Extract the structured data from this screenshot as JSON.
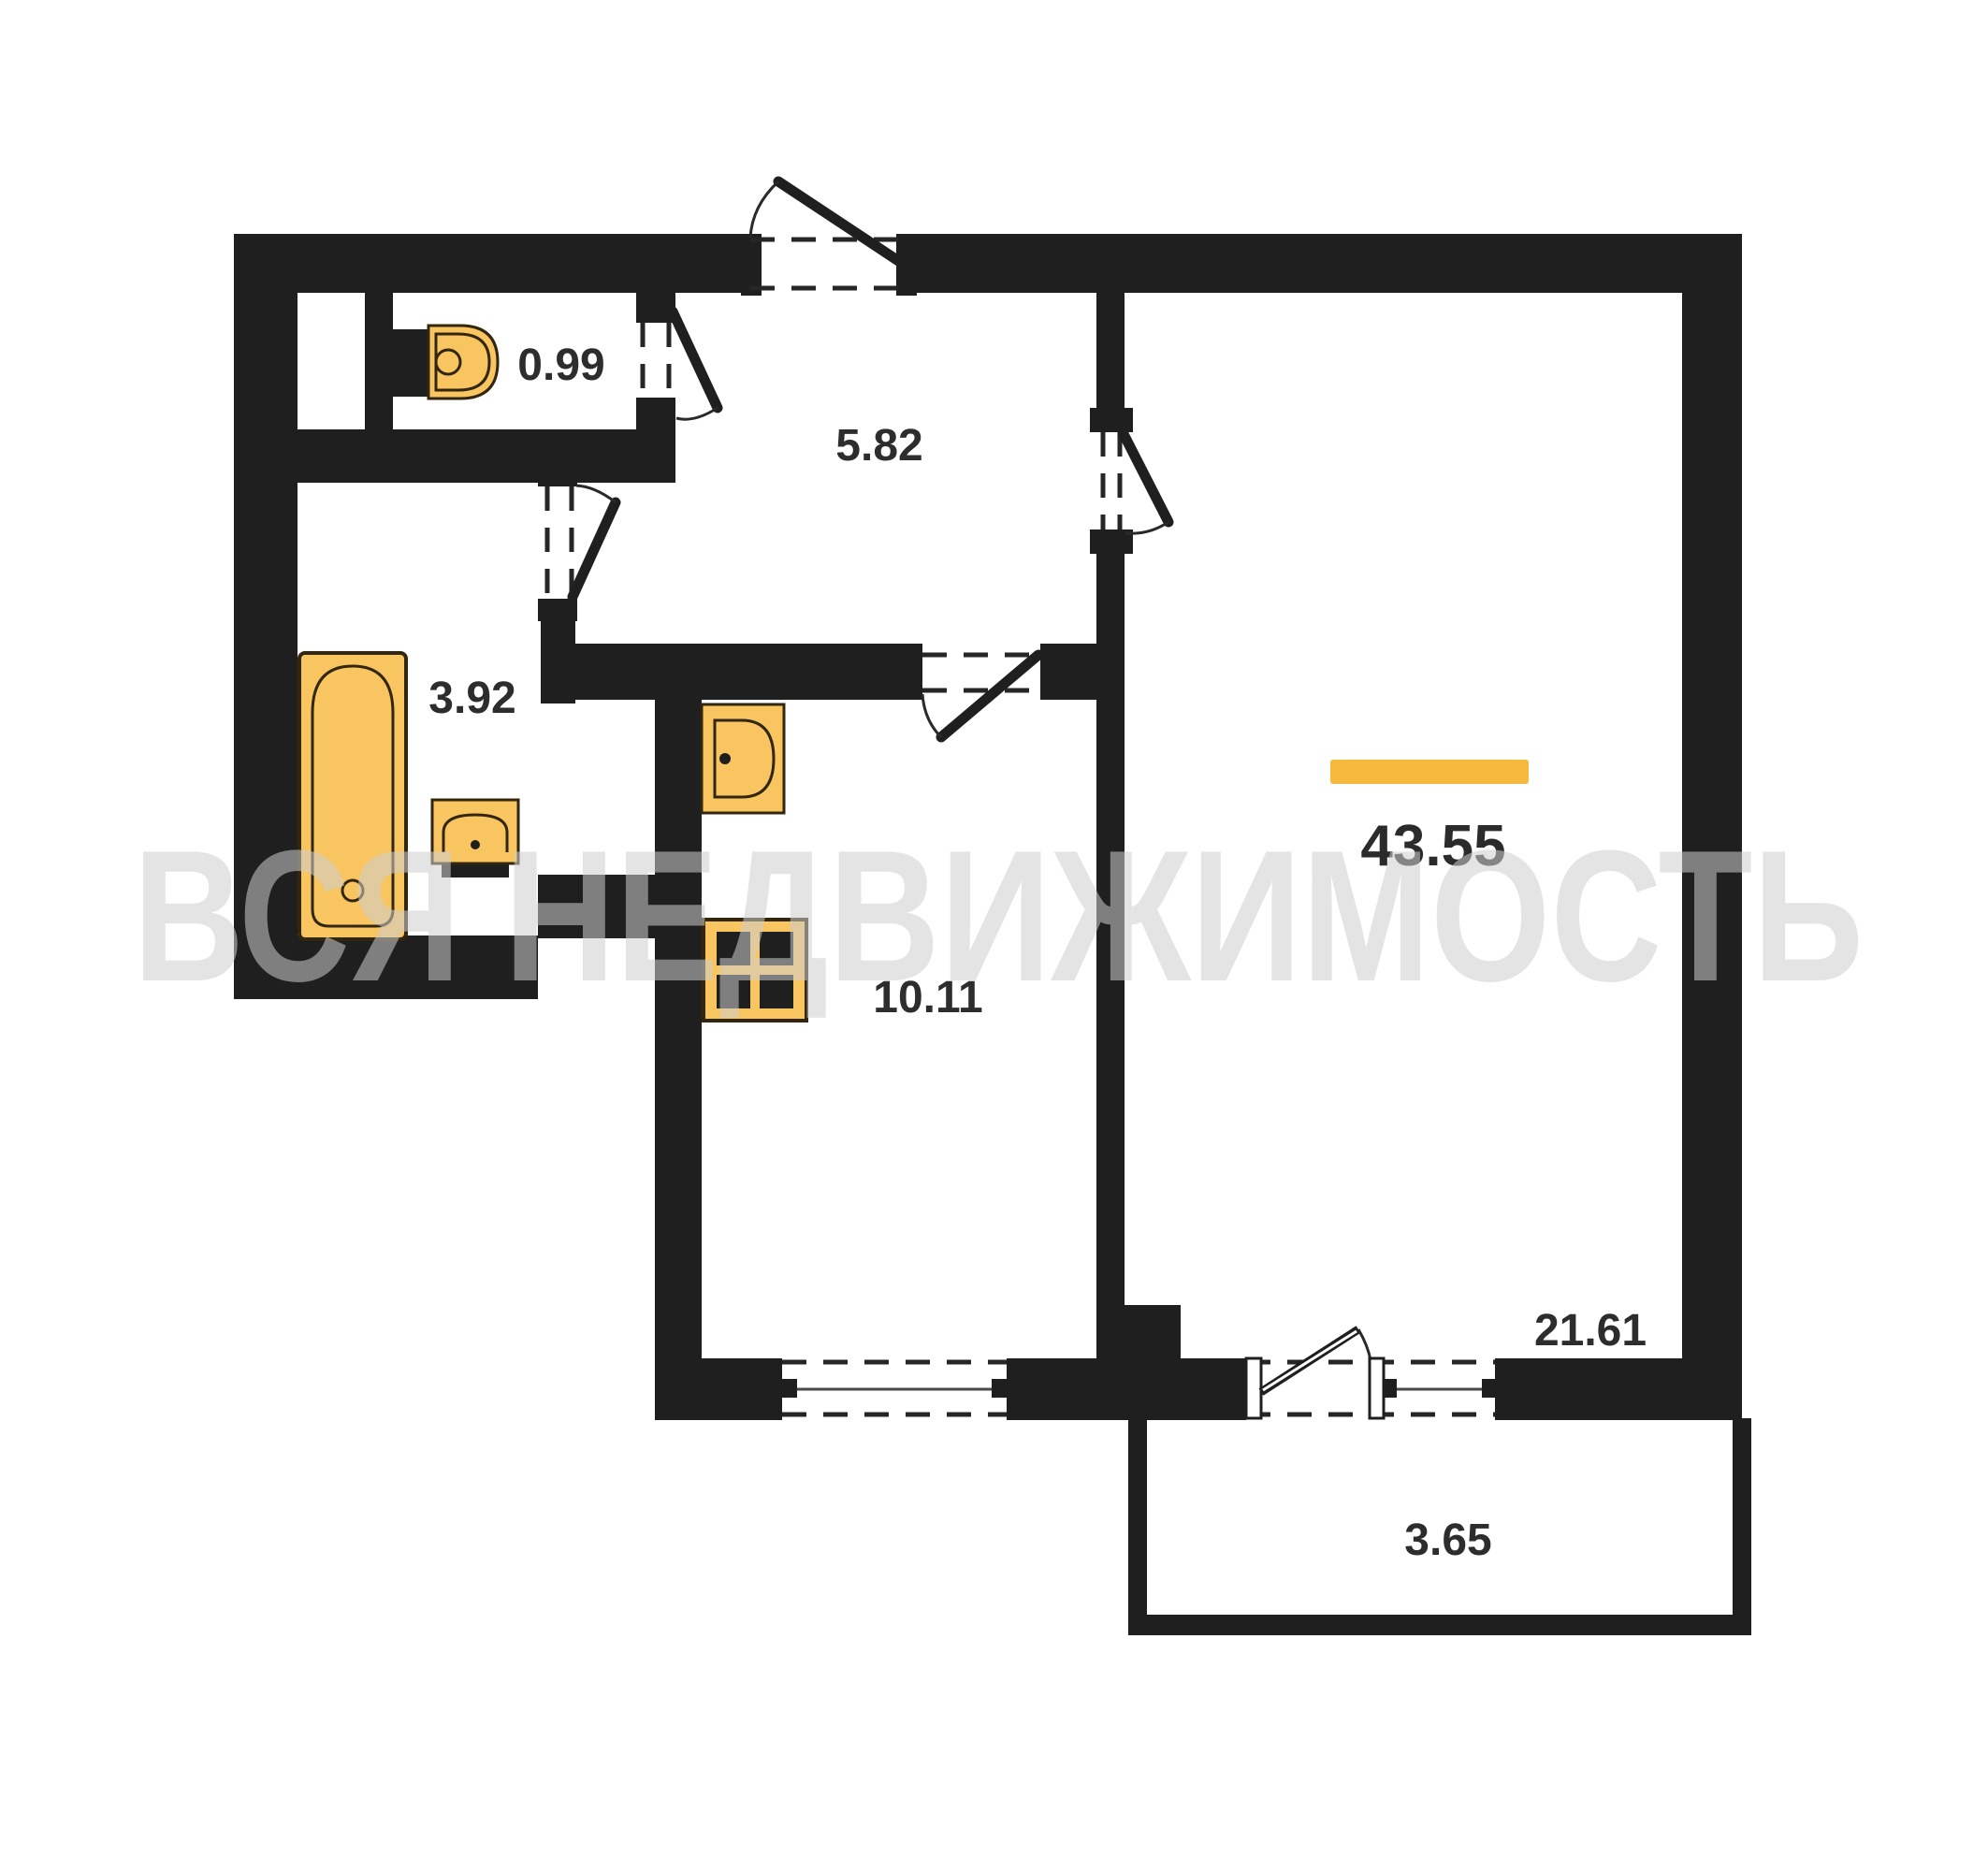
{
  "plan": {
    "title": "apartment-floor-plan",
    "watermark": "ВСЯ НЕДВИЖИМОСТЬ",
    "total_area": {
      "value": "43.55"
    },
    "rooms": [
      {
        "id": "toilet",
        "area": "0.99"
      },
      {
        "id": "hallway",
        "area": "5.82"
      },
      {
        "id": "bathroom",
        "area": "3.92"
      },
      {
        "id": "kitchen",
        "area": "10.11"
      },
      {
        "id": "living-room",
        "area": "21.61"
      },
      {
        "id": "balcony",
        "area": "3.65"
      }
    ],
    "fixtures": [
      "toilet-icon",
      "bathtub-icon",
      "bathroom-sink-icon",
      "kitchen-sink-icon",
      "stove-icon"
    ],
    "colors": {
      "wall": "#1f1f1f",
      "fixture_fill": "#F8C561",
      "fixture_stroke": "#33260f",
      "accent": "#F5B93E",
      "label": "#2d2d2d",
      "watermark": "#cfcfcf"
    }
  }
}
